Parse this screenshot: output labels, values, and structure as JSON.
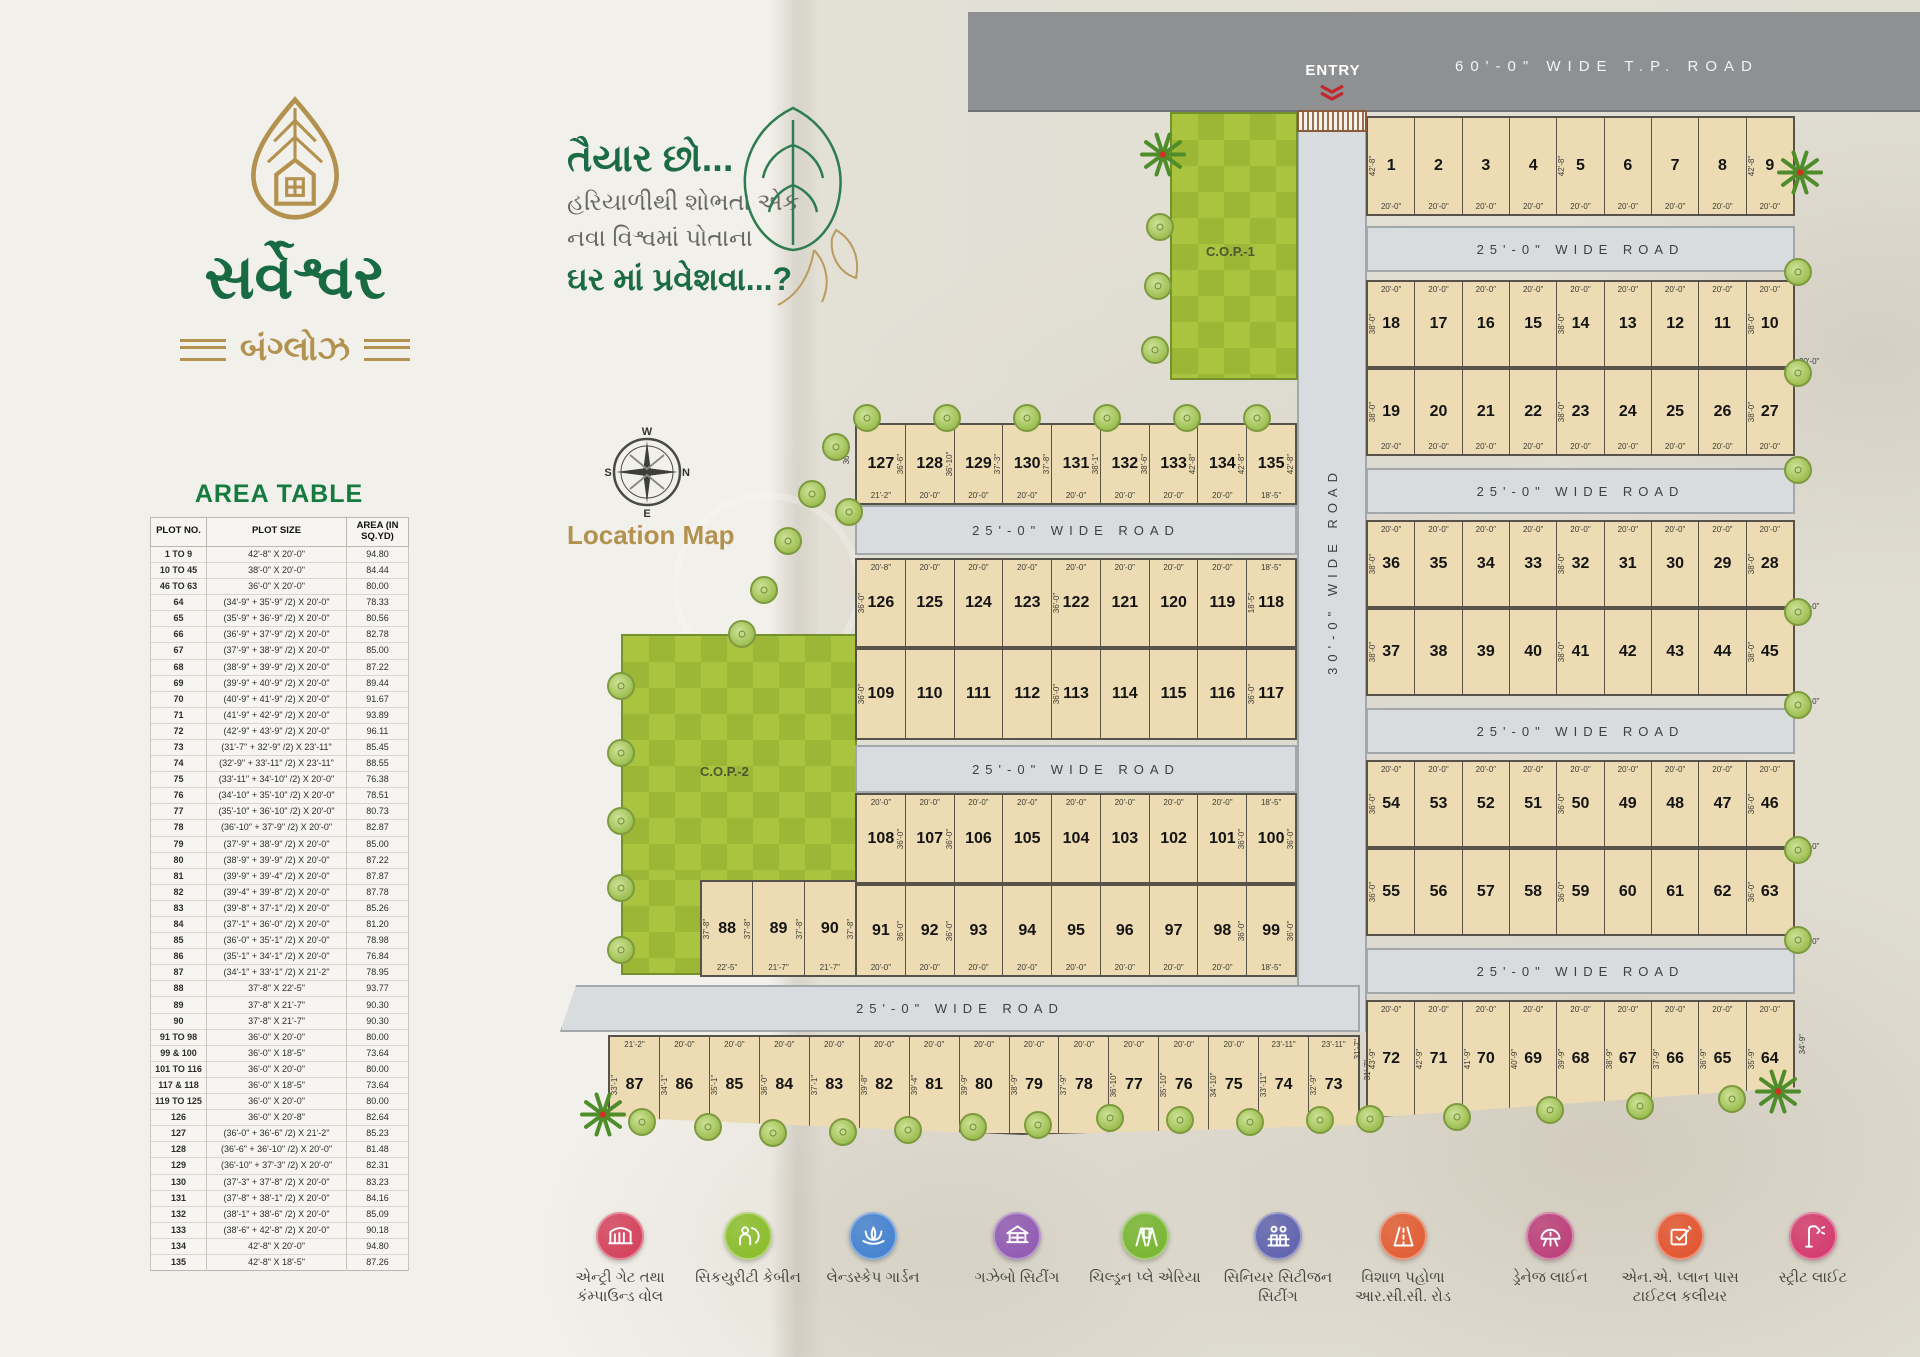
{
  "brand": {
    "title": "સર્વેશ્વર",
    "subtitle": "બંગ્લોઝ",
    "logo_icon": "leaf-house-logo"
  },
  "tagline": {
    "line1": "તૈયાર છો...",
    "line2": "હરિયાળીથી શોભતા એક",
    "line3": "નવા વિશ્વમાં પોતાના",
    "line4": "ઘર માં પ્રવેશવા...?"
  },
  "location_map_label": "Location Map",
  "compass": {
    "top": "W",
    "left": "S",
    "right": "N",
    "bottom": "E"
  },
  "area_table": {
    "title": "AREA TABLE",
    "headers": [
      "PLOT NO.",
      "PLOT SIZE",
      "AREA (IN SQ.YD)"
    ],
    "rows": [
      [
        "1 TO 9",
        "42'-8\" X 20'-0\"",
        "94.80"
      ],
      [
        "10 TO 45",
        "38'-0\" X 20'-0\"",
        "84.44"
      ],
      [
        "46 TO 63",
        "36'-0\" X 20'-0\"",
        "80.00"
      ],
      [
        "64",
        "(34'-9\" + 35'-9\" /2) X 20'-0\"",
        "78.33"
      ],
      [
        "65",
        "(35'-9\" + 36'-9\" /2) X 20'-0\"",
        "80.56"
      ],
      [
        "66",
        "(36'-9\" + 37'-9\" /2) X 20'-0\"",
        "82.78"
      ],
      [
        "67",
        "(37'-9\" + 38'-9\" /2) X 20'-0\"",
        "85.00"
      ],
      [
        "68",
        "(38'-9\" + 39'-9\" /2) X 20'-0\"",
        "87.22"
      ],
      [
        "69",
        "(39'-9\" + 40'-9\" /2) X 20'-0\"",
        "89.44"
      ],
      [
        "70",
        "(40'-9\" + 41'-9\" /2) X 20'-0\"",
        "91.67"
      ],
      [
        "71",
        "(41'-9\" + 42'-9\" /2) X 20'-0\"",
        "93.89"
      ],
      [
        "72",
        "(42'-9\" + 43'-9\" /2) X 20'-0\"",
        "96.11"
      ],
      [
        "73",
        "(31'-7\" + 32'-9\" /2) X 23'-11\"",
        "85.45"
      ],
      [
        "74",
        "(32'-9\" + 33'-11\" /2) X 23'-11\"",
        "88.55"
      ],
      [
        "75",
        "(33'-11\" + 34'-10\" /2) X 20'-0\"",
        "76.38"
      ],
      [
        "76",
        "(34'-10\" + 35'-10\" /2) X 20'-0\"",
        "78.51"
      ],
      [
        "77",
        "(35'-10\" + 36'-10\" /2) X 20'-0\"",
        "80.73"
      ],
      [
        "78",
        "(36'-10\" + 37'-9\" /2) X 20'-0\"",
        "82.87"
      ],
      [
        "79",
        "(37'-9\" + 38'-9\" /2) X 20'-0\"",
        "85.00"
      ],
      [
        "80",
        "(38'-9\" + 39'-9\" /2) X 20'-0\"",
        "87.22"
      ],
      [
        "81",
        "(39'-9\" + 39'-4\" /2) X 20'-0\"",
        "87.87"
      ],
      [
        "82",
        "(39'-4\" + 39'-8\" /2) X 20'-0\"",
        "87.78"
      ],
      [
        "83",
        "(39'-8\" + 37'-1\" /2) X 20'-0\"",
        "85.26"
      ],
      [
        "84",
        "(37'-1\" + 36'-0\" /2) X 20'-0\"",
        "81.20"
      ],
      [
        "85",
        "(36'-0\" + 35'-1\" /2) X 20'-0\"",
        "78.98"
      ],
      [
        "86",
        "(35'-1\" + 34'-1\" /2) X 20'-0\"",
        "76.84"
      ],
      [
        "87",
        "(34'-1\" + 33'-1\" /2) X 21'-2\"",
        "78.95"
      ],
      [
        "88",
        "37'-8\" X 22'-5\"",
        "93.77"
      ],
      [
        "89",
        "37'-8\" X 21'-7\"",
        "90.30"
      ],
      [
        "90",
        "37'-8\" X 21'-7\"",
        "90.30"
      ],
      [
        "91 TO 98",
        "36'-0\" X 20'-0\"",
        "80.00"
      ],
      [
        "99 & 100",
        "36'-0\" X 18'-5\"",
        "73.64"
      ],
      [
        "101 TO 116",
        "36'-0\" X 20'-0\"",
        "80.00"
      ],
      [
        "117 & 118",
        "36'-0\" X 18'-5\"",
        "73.64"
      ],
      [
        "119 TO 125",
        "36'-0\" X 20'-0\"",
        "80.00"
      ],
      [
        "126",
        "36'-0\" X 20'-8\"",
        "82.64"
      ],
      [
        "127",
        "(36'-0\" + 36'-6\" /2) X 21'-2\"",
        "85.23"
      ],
      [
        "128",
        "(36'-6\" + 36'-10\" /2) X 20'-0\"",
        "81.48"
      ],
      [
        "129",
        "(36'-10\" + 37'-3\" /2) X 20'-0\"",
        "82.31"
      ],
      [
        "130",
        "(37'-3\" + 37'-8\" /2) X 20'-0\"",
        "83.23"
      ],
      [
        "131",
        "(37'-8\" + 38'-1\" /2) X 20'-0\"",
        "84.16"
      ],
      [
        "132",
        "(38'-1\" + 38'-6\" /2) X 20'-0\"",
        "85.09"
      ],
      [
        "133",
        "(38'-6\" + 42'-8\" /2) X 20'-0\"",
        "90.18"
      ],
      [
        "134",
        "42'-8\" X 20'-0\"",
        "94.80"
      ],
      [
        "135",
        "42'-8\" X 18'-5\"",
        "87.26"
      ]
    ]
  },
  "map": {
    "tp_road_label": "60'-0\" WIDE T.P. ROAD",
    "entry_label": "ENTRY",
    "road25_label": "25'-0\" WIDE ROAD",
    "road30_label": "30'-0\" WIDE ROAD",
    "cop1_label": "C.O.P.-1",
    "cop2_label": "C.O.P.-2",
    "edge_dim_label": "20'-0\"",
    "blocks": [
      {
        "id": "rowA",
        "nums": [
          "1",
          "2",
          "3",
          "4",
          "5",
          "6",
          "7",
          "8",
          "9"
        ],
        "bottom": [
          "20'-0\"",
          "20'-0\"",
          "20'-0\"",
          "20'-0\"",
          "20'-0\"",
          "20'-0\"",
          "20'-0\"",
          "20'-0\"",
          "20'-0\""
        ],
        "lrot": [
          "42'-8\"",
          null,
          null,
          null,
          "42'-8\"",
          null,
          null,
          null,
          "42'-8\""
        ]
      },
      {
        "id": "rowB",
        "nums": [
          "18",
          "17",
          "16",
          "15",
          "14",
          "13",
          "12",
          "11",
          "10"
        ],
        "top": [
          "20'-0\"",
          "20'-0\"",
          "20'-0\"",
          "20'-0\"",
          "20'-0\"",
          "20'-0\"",
          "20'-0\"",
          "20'-0\"",
          "20'-0\""
        ],
        "lrot": [
          "38'-0\"",
          null,
          null,
          null,
          "38'-0\"",
          null,
          null,
          null,
          "38'-0\""
        ]
      },
      {
        "id": "rowC",
        "nums": [
          "19",
          "20",
          "21",
          "22",
          "23",
          "24",
          "25",
          "26",
          "27"
        ],
        "bottom": [
          "20'-0\"",
          "20'-0\"",
          "20'-0\"",
          "20'-0\"",
          "20'-0\"",
          "20'-0\"",
          "20'-0\"",
          "20'-0\"",
          "20'-0\""
        ],
        "lrot": [
          "38'-0\"",
          null,
          null,
          null,
          "38'-0\"",
          null,
          null,
          null,
          "38'-0\""
        ]
      },
      {
        "id": "rowD",
        "nums": [
          "36",
          "35",
          "34",
          "33",
          "32",
          "31",
          "30",
          "29",
          "28"
        ],
        "top": [
          "20'-0\"",
          "20'-0\"",
          "20'-0\"",
          "20'-0\"",
          "20'-0\"",
          "20'-0\"",
          "20'-0\"",
          "20'-0\"",
          "20'-0\""
        ],
        "lrot": [
          "38'-0\"",
          null,
          null,
          null,
          "38'-0\"",
          null,
          null,
          null,
          "38'-0\""
        ]
      },
      {
        "id": "rowE",
        "nums": [
          "37",
          "38",
          "39",
          "40",
          "41",
          "42",
          "43",
          "44",
          "45"
        ],
        "lrot": [
          "38'-0\"",
          null,
          null,
          null,
          "38'-0\"",
          null,
          null,
          null,
          "38'-0\""
        ]
      },
      {
        "id": "rowF",
        "nums": [
          "54",
          "53",
          "52",
          "51",
          "50",
          "49",
          "48",
          "47",
          "46"
        ],
        "top": [
          "20'-0\"",
          "20'-0\"",
          "20'-0\"",
          "20'-0\"",
          "20'-0\"",
          "20'-0\"",
          "20'-0\"",
          "20'-0\"",
          "20'-0\""
        ],
        "lrot": [
          "36'-0\"",
          null,
          null,
          null,
          "36'-0\"",
          null,
          null,
          null,
          "36'-0\""
        ]
      },
      {
        "id": "rowG",
        "nums": [
          "55",
          "56",
          "57",
          "58",
          "59",
          "60",
          "61",
          "62",
          "63"
        ],
        "lrot": [
          "36'-0\"",
          null,
          null,
          null,
          "36'-0\"",
          null,
          null,
          null,
          "36'-0\""
        ]
      },
      {
        "id": "rowH",
        "nums": [
          "72",
          "71",
          "70",
          "69",
          "68",
          "67",
          "66",
          "65",
          "64"
        ],
        "top": [
          "20'-0\"",
          "20'-0\"",
          "20'-0\"",
          "20'-0\"",
          "20'-0\"",
          "20'-0\"",
          "20'-0\"",
          "20'-0\"",
          "20'-0\""
        ],
        "lrot": [
          "43'-9\"",
          "42'-9\"",
          "41'-9\"",
          "40'-9\"",
          "39'-9\"",
          "38'-9\"",
          "37'-9\"",
          "36'-9\"",
          "35'-9\""
        ],
        "ledge": "31'-7\"",
        "redge": "34'-9\""
      },
      {
        "id": "row127",
        "nums": [
          "127",
          "128",
          "129",
          "130",
          "131",
          "132",
          "133",
          "134",
          "135"
        ],
        "bottom": [
          "21'-2\"",
          "20'-0\"",
          "20'-0\"",
          "20'-0\"",
          "20'-0\"",
          "20'-0\"",
          "20'-0\"",
          "20'-0\"",
          "18'-5\""
        ],
        "rrot": [
          "36'-6\"",
          "36'-10\"",
          "37'-3\"",
          "37'-8\"",
          "38'-1\"",
          "38'-6\"",
          "42'-8\"",
          "42'-8\"",
          "42'-8\""
        ],
        "ledge": "36'-0\""
      },
      {
        "id": "row126",
        "nums": [
          "126",
          "125",
          "124",
          "123",
          "122",
          "121",
          "120",
          "119",
          "118"
        ],
        "top": [
          "20'-8\"",
          "20'-0\"",
          "20'-0\"",
          "20'-0\"",
          "20'-0\"",
          "20'-0\"",
          "20'-0\"",
          "20'-0\"",
          "18'-5\""
        ],
        "lrot": [
          "36'-0\"",
          null,
          null,
          null,
          "36'-0\"",
          null,
          null,
          null,
          "18'-5\""
        ]
      },
      {
        "id": "row109",
        "nums": [
          "109",
          "110",
          "111",
          "112",
          "113",
          "114",
          "115",
          "116",
          "117"
        ],
        "lrot": [
          "36'-0\"",
          null,
          null,
          null,
          "36'-0\"",
          null,
          null,
          null,
          "36'-0\""
        ]
      },
      {
        "id": "row108",
        "nums": [
          "108",
          "107",
          "106",
          "105",
          "104",
          "103",
          "102",
          "101",
          "100"
        ],
        "top": [
          "20'-0\"",
          "20'-0\"",
          "20'-0\"",
          "20'-0\"",
          "20'-0\"",
          "20'-0\"",
          "20'-0\"",
          "20'-0\"",
          "18'-5\""
        ],
        "rrot": [
          "36'-0\"",
          "36'-0\"",
          null,
          null,
          null,
          null,
          null,
          "36'-0\"",
          "36'-0\""
        ]
      },
      {
        "id": "row91",
        "nums": [
          "91",
          "92",
          "93",
          "94",
          "95",
          "96",
          "97",
          "98",
          "99"
        ],
        "bottom": [
          "20'-0\"",
          "20'-0\"",
          "20'-0\"",
          "20'-0\"",
          "20'-0\"",
          "20'-0\"",
          "20'-0\"",
          "20'-0\"",
          "18'-5\""
        ],
        "rrot": [
          "36'-0\"",
          "36'-0\"",
          null,
          null,
          null,
          null,
          null,
          "36'-0\"",
          "36'-0\""
        ]
      },
      {
        "id": "row88",
        "nums": [
          "88",
          "89",
          "90"
        ],
        "bottom": [
          "22'-5\"",
          "21'-7\"",
          "21'-7\""
        ],
        "lrot": [
          "37'-8\"",
          null,
          null
        ],
        "rrot": [
          "37'-8\"",
          "37'-8\"",
          "37'-8\""
        ]
      },
      {
        "id": "row87",
        "nums": [
          "87",
          "86",
          "85",
          "84",
          "83",
          "82",
          "81",
          "80",
          "79",
          "78",
          "77",
          "76",
          "75",
          "74",
          "73"
        ],
        "top": [
          "21'-2\"",
          "20'-0\"",
          "20'-0\"",
          "20'-0\"",
          "20'-0\"",
          "20'-0\"",
          "20'-0\"",
          "20'-0\"",
          "20'-0\"",
          "20'-0\"",
          "20'-0\"",
          "20'-0\"",
          "20'-0\"",
          "23'-11\"",
          "23'-11\""
        ],
        "lrot": [
          "33'-1\"",
          "34'-1\"",
          "35'-1\"",
          "36'-0\"",
          "37'-1\"",
          "39'-8\"",
          "39'-4\"",
          "39'-9\"",
          "38'-9\"",
          "37'-9\"",
          "36'-10\"",
          "35'-10\"",
          "34'-10\"",
          "33'-11\"",
          "32'-9\""
        ],
        "redge": "31'-7\""
      }
    ]
  },
  "legend": [
    {
      "label": "એન્ટ્રી ગેટ તથા કંમ્પાઉન્ડ વોલ",
      "color": "#d23a56",
      "icon": "entry-gate-icon"
    },
    {
      "label": "સિકયુરીટી કેબીન",
      "color": "#86bb23",
      "icon": "security-cabin-icon"
    },
    {
      "label": "લેન્ડસ્કેપ ગાર્ડન",
      "color": "#3f7fd2",
      "icon": "lotus-icon"
    },
    {
      "label": "ગઝેબો સિટીંગ",
      "color": "#8e56b3",
      "icon": "gazebo-icon"
    },
    {
      "label": "ચિલ્ડ્રન પ્લે એરિયા",
      "color": "#74b52c",
      "icon": "swing-icon"
    },
    {
      "label": "સિનિયર સિટીજન સિટીંગ",
      "color": "#5b5fae",
      "icon": "bench-people-icon"
    },
    {
      "label": "વિશાળ પહોળા આર.સી.સી. રોડ",
      "color": "#e2592e",
      "icon": "road-icon"
    },
    {
      "label": "ડ્રેનેજ લાઈન",
      "color": "#bb3a78",
      "icon": "drain-icon"
    },
    {
      "label": "એન.એ. પ્લાન પાસ ટાઈટલ કલીયર",
      "color": "#e4502a",
      "icon": "plan-pencil-icon"
    },
    {
      "label": "સ્ટ્રીટ લાઈટ",
      "color": "#d4356b",
      "icon": "street-light-icon"
    }
  ],
  "colors": {
    "brand_green": "#186a43",
    "brand_gold": "#b3914f",
    "table_title_green": "#147a3e",
    "plot_fill": "#eddcb3",
    "road_fill": "#d9dcde",
    "tp_road_fill": "#8e9092",
    "cop_green": "#a3bf3a",
    "entry_red": "#c2262c"
  }
}
